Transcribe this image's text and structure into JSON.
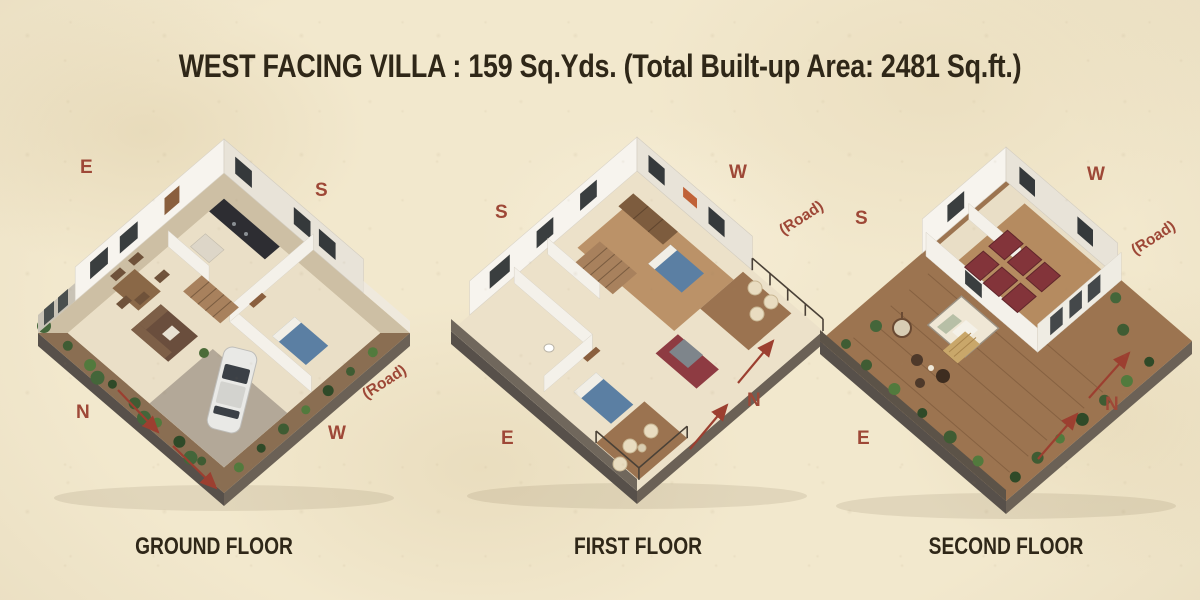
{
  "title": "WEST FACING VILLA : 159 Sq.Yds. (Total Built-up Area: 2481 Sq.ft.)",
  "floors": [
    {
      "label": "GROUND FLOOR",
      "compass": {
        "top_left": "E",
        "top_right": "S",
        "bottom_left": "N",
        "bottom_right": "W"
      },
      "road": "(Road)"
    },
    {
      "label": "FIRST FLOOR",
      "compass": {
        "top_left": "S",
        "top_right": "W",
        "bottom_left": "E",
        "bottom_right": "N"
      },
      "road": "(Road)"
    },
    {
      "label": "SECOND FLOOR",
      "compass": {
        "top_left": "S",
        "top_right": "W",
        "bottom_left": "E",
        "bottom_right": "N"
      },
      "road": "(Road)"
    }
  ],
  "colors": {
    "background": "#f2e8cd",
    "heading_text": "#2f2718",
    "compass_text": "#9e4837",
    "arrow": "#9c3f30"
  }
}
